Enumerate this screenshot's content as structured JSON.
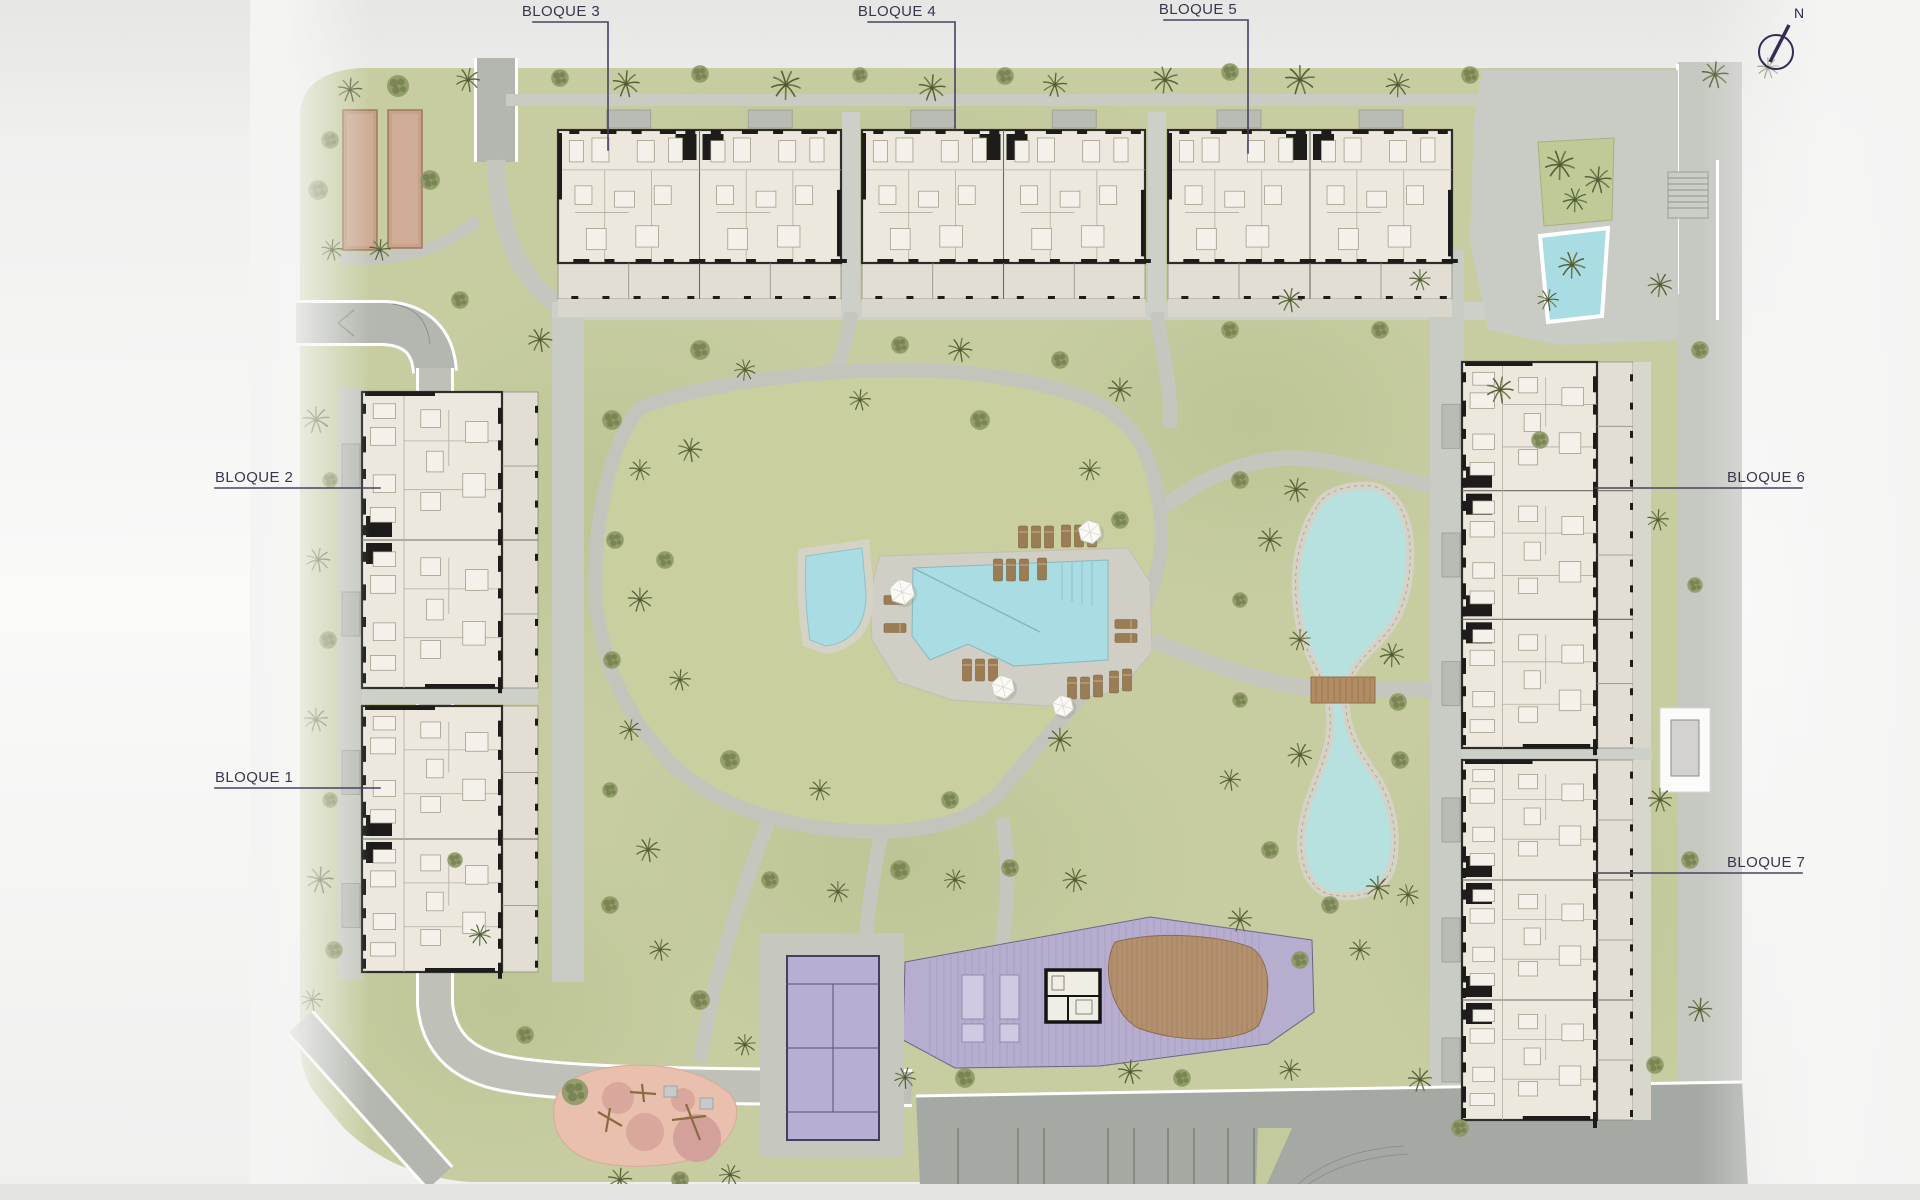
{
  "labels": {
    "bloque1": "BLOQUE 1",
    "bloque2": "BLOQUE 2",
    "bloque3": "BLOQUE 3",
    "bloque4": "BLOQUE 4",
    "bloque5": "BLOQUE 5",
    "bloque6": "BLOQUE 6",
    "bloque7": "BLOQUE 7"
  },
  "compass": {
    "north": "N"
  },
  "palette": {
    "grass": "#c7cda1",
    "grassDark": "#b9c191",
    "mound": "#c9cf9f",
    "path": "#c5c7bf",
    "walk": "#c9cbc5",
    "road": "#b4b7b0",
    "roadDark": "#a5a9a3",
    "water": "#a9dde3",
    "waterEdge": "#8fc3c9",
    "stone": "#d6d2c5",
    "building": "#ece8de",
    "terrace": "#e2ded3",
    "canopy": "#b9bbb5",
    "wall": "#1d1c1a",
    "thin": "#6e6a60",
    "faint": "#b3aea1",
    "furn": "#98937f",
    "purple": "#b7aecf",
    "court": "#b6aed3",
    "courtLine": "#44405c",
    "playground": "#e9c0ae",
    "playPatch": "#d9a79b",
    "wood": "#b4916e",
    "woodDark": "#96754f",
    "bridge": "#b28c63",
    "tan": "#c7a189",
    "lounger": "#9a7c55",
    "label": "#3c3450",
    "line": "#4b4163",
    "tree": "#6c7848",
    "treeDark": "#57613a",
    "bush": "#8d9865",
    "bushDark": "#76814f"
  }
}
